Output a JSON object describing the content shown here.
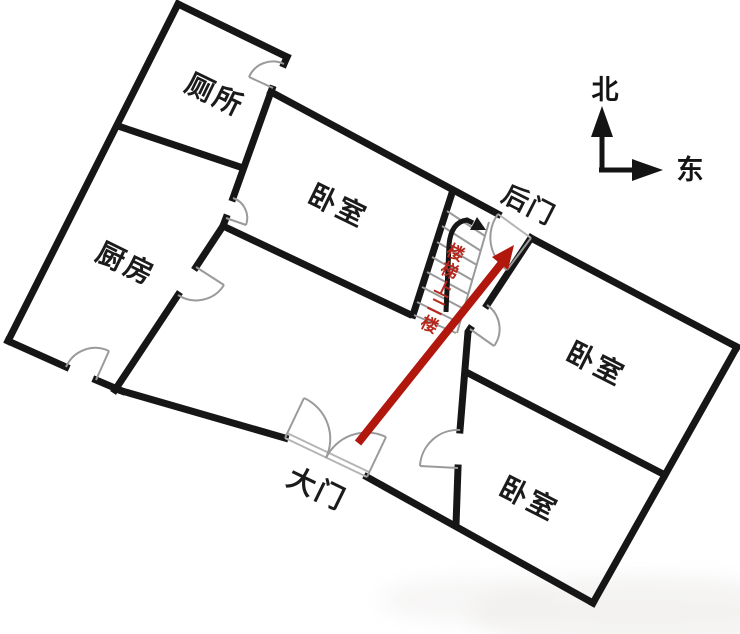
{
  "rooms": {
    "toilet": "厕所",
    "kitchen": "厨房",
    "bedroom_top": "卧室",
    "bedroom_right_upper": "卧室",
    "bedroom_right_lower": "卧室"
  },
  "doors": {
    "main": "大门",
    "back": "后门"
  },
  "stairs": {
    "note": "楼梯上二楼",
    "chars": [
      "楼",
      "梯",
      "上",
      "二",
      "楼"
    ]
  },
  "compass": {
    "north": "北",
    "east": "东"
  },
  "colors": {
    "wall": "#161616",
    "door_arc": "#9a9a9a",
    "route_red": "#b2170e",
    "stair_text_red": "#b5281e"
  }
}
